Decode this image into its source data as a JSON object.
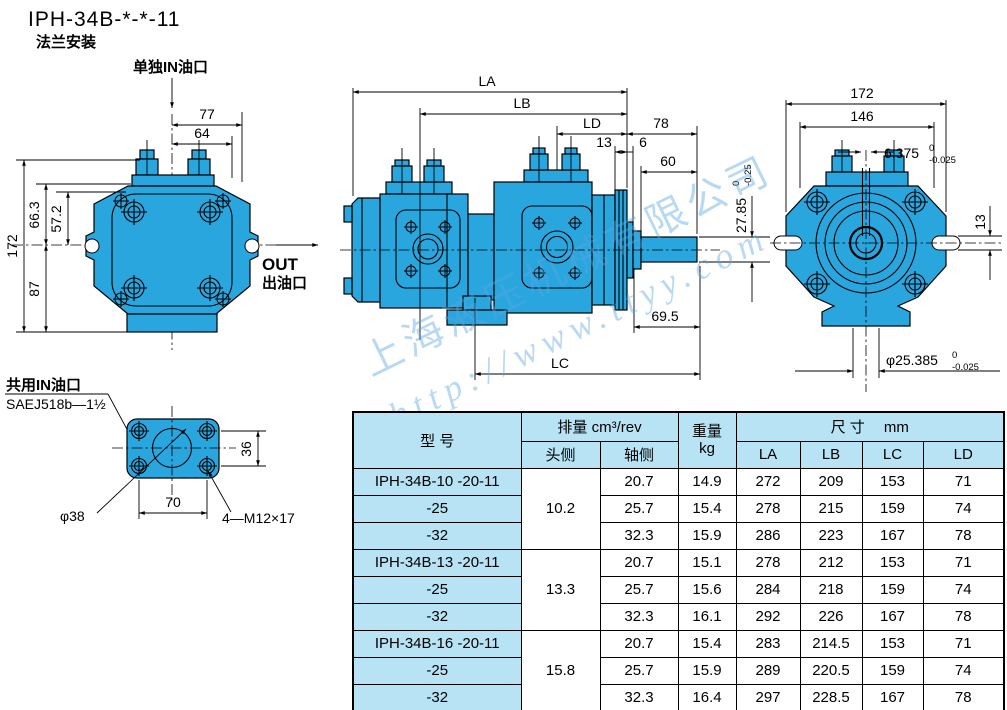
{
  "title": "IPH-34B-*-*-11",
  "subtitle": "法兰安装",
  "watermark": {
    "line1": "上海液压机械有限公司",
    "line2": "http://www.ttyy.com"
  },
  "front_view": {
    "in_label": "单独IN油口",
    "out_label": "OUT",
    "out_sub": "出油口",
    "dims": {
      "d77": "77",
      "d64": "64",
      "d663": "66.3",
      "d572": "57.2",
      "d172": "172",
      "d87": "87"
    }
  },
  "side_view": {
    "dims": {
      "la": "LA",
      "lb": "LB",
      "ld": "LD",
      "d13": "13",
      "d6": "6",
      "d78": "78",
      "d60": "60",
      "d695": "69.5",
      "lc": "LC",
      "shaft_h": "27.85",
      "shaft_h_tol_up": "0",
      "shaft_h_tol_dn": "-0.25"
    }
  },
  "rear_view": {
    "dims": {
      "d172": "172",
      "d146": "146",
      "key": "6.375",
      "key_tol_up": "0",
      "key_tol_dn": "-0.025",
      "d13": "13",
      "shaft_d": "φ25.385",
      "shaft_d_tol_up": "0",
      "shaft_d_tol_dn": "-0.025"
    }
  },
  "inlet_flange": {
    "label1": "共用IN油口",
    "label2": "SAEJ518b—1½",
    "dims": {
      "d36": "36",
      "d38": "φ38",
      "d70": "70",
      "bolts": "4—M12×17"
    }
  },
  "table": {
    "headers": {
      "model": "型 号",
      "displacement": "排量  cm³/rev",
      "head_side": "头侧",
      "shaft_side": "轴侧",
      "weight_l1": "重量",
      "weight_l2": "kg",
      "dims": "尺 寸　 mm",
      "la": "LA",
      "lb": "LB",
      "lc": "LC",
      "ld": "LD"
    },
    "groups": [
      {
        "head": "10.2",
        "rows": [
          {
            "model": "IPH-34B-10 -20-11",
            "shaft": "20.7",
            "weight": "14.9",
            "la": "272",
            "lb": "209",
            "lc": "153",
            "ld": "71"
          },
          {
            "model": "-25",
            "shaft": "25.7",
            "weight": "15.4",
            "la": "278",
            "lb": "215",
            "lc": "159",
            "ld": "74"
          },
          {
            "model": "-32",
            "shaft": "32.3",
            "weight": "15.9",
            "la": "286",
            "lb": "223",
            "lc": "167",
            "ld": "78"
          }
        ]
      },
      {
        "head": "13.3",
        "rows": [
          {
            "model": "IPH-34B-13 -20-11",
            "shaft": "20.7",
            "weight": "15.1",
            "la": "278",
            "lb": "212",
            "lc": "153",
            "ld": "71"
          },
          {
            "model": "-25",
            "shaft": "25.7",
            "weight": "15.6",
            "la": "284",
            "lb": "218",
            "lc": "159",
            "ld": "74"
          },
          {
            "model": "-32",
            "shaft": "32.3",
            "weight": "16.1",
            "la": "292",
            "lb": "226",
            "lc": "167",
            "ld": "78"
          }
        ]
      },
      {
        "head": "15.8",
        "rows": [
          {
            "model": "IPH-34B-16 -20-11",
            "shaft": "20.7",
            "weight": "15.4",
            "la": "283",
            "lb": "214.5",
            "lc": "153",
            "ld": "71"
          },
          {
            "model": "-25",
            "shaft": "25.7",
            "weight": "15.9",
            "la": "289",
            "lb": "220.5",
            "lc": "159",
            "ld": "74"
          },
          {
            "model": "-32",
            "shaft": "32.3",
            "weight": "16.4",
            "la": "297",
            "lb": "228.5",
            "lc": "167",
            "ld": "78"
          }
        ]
      }
    ]
  },
  "colors": {
    "pump": "#2AA6DF",
    "table_blue": "#B7E3F4",
    "line": "#000000",
    "watermark": "#58A4E0"
  }
}
